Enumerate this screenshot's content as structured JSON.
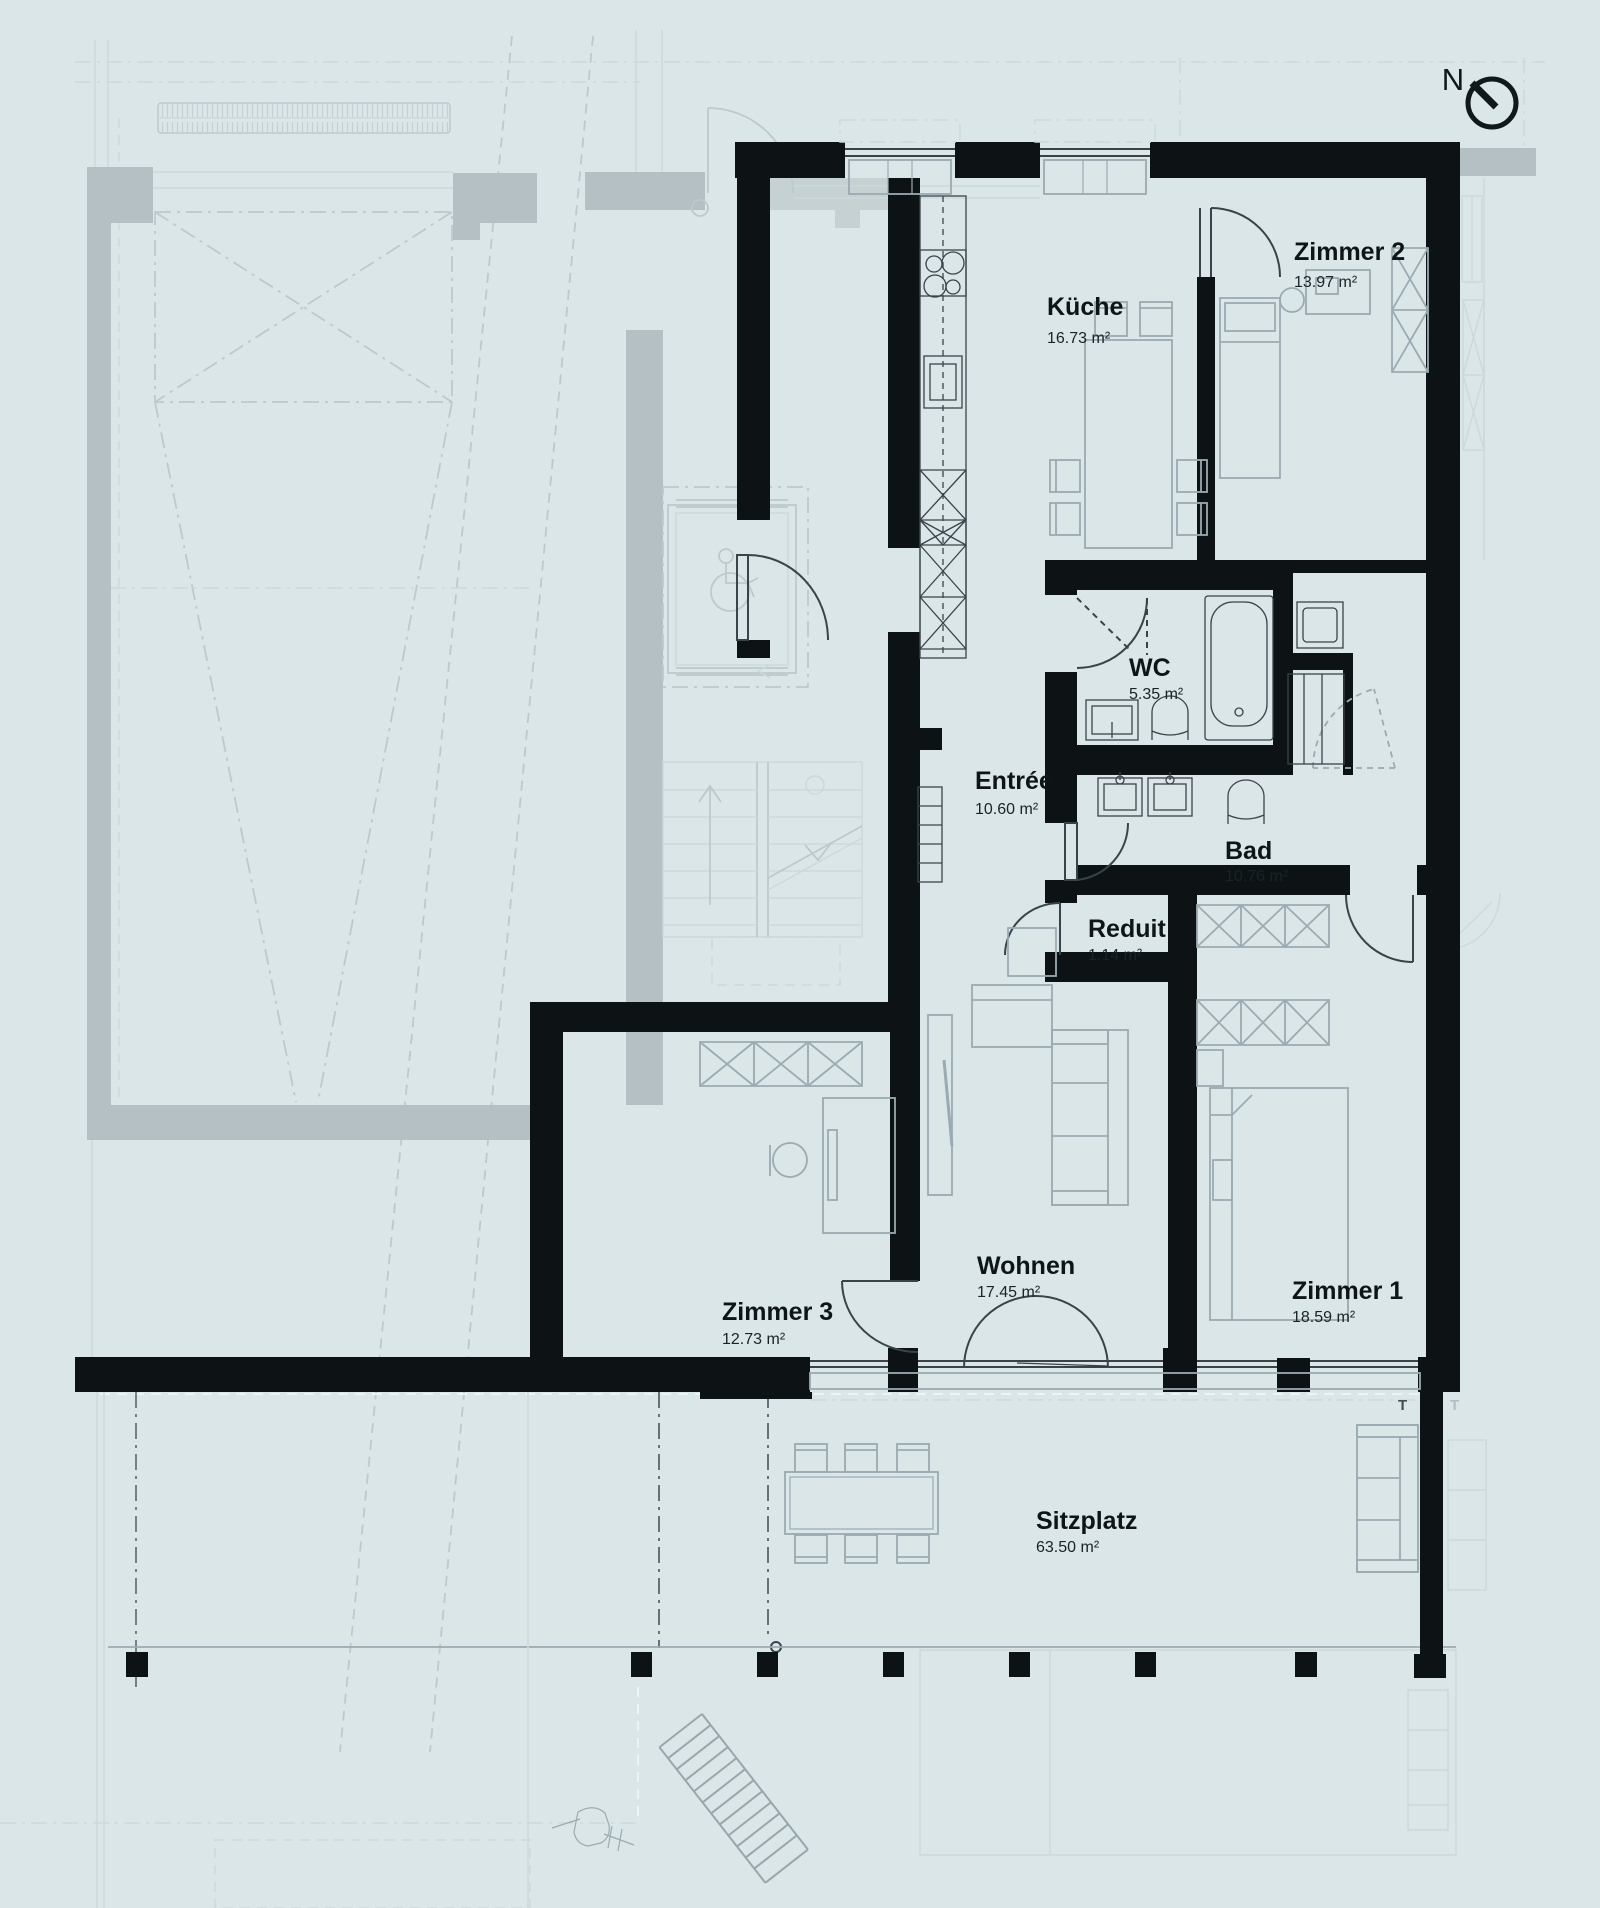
{
  "compass": {
    "label": "N"
  },
  "rooms": {
    "kueche": {
      "name": "Küche",
      "area": "16.73 m²"
    },
    "zimmer2": {
      "name": "Zimmer 2",
      "area": "13.97 m²"
    },
    "wc": {
      "name": "WC",
      "area": "5.35 m²"
    },
    "entree": {
      "name": "Entrée",
      "area": "10.60 m²"
    },
    "bad": {
      "name": "Bad",
      "area": "10.76 m²"
    },
    "reduit": {
      "name": "Reduit",
      "area": "1.14 m²"
    },
    "zimmer3": {
      "name": "Zimmer 3",
      "area": "12.73 m²"
    },
    "wohnen": {
      "name": "Wohnen",
      "area": "17.45 m²"
    },
    "zimmer1": {
      "name": "Zimmer 1",
      "area": "18.59 m²"
    },
    "sitzplatz": {
      "name": "Sitzplatz",
      "area": "63.50 m²"
    }
  },
  "markers": {
    "t_inner": "T",
    "t_outer": "T"
  },
  "colors": {
    "background": "#dbe6e9",
    "wall": "#0d1315",
    "faded_wall": "#b4c0c3",
    "furniture_line": "#9aabb1",
    "fixture_line": "#39444a"
  }
}
